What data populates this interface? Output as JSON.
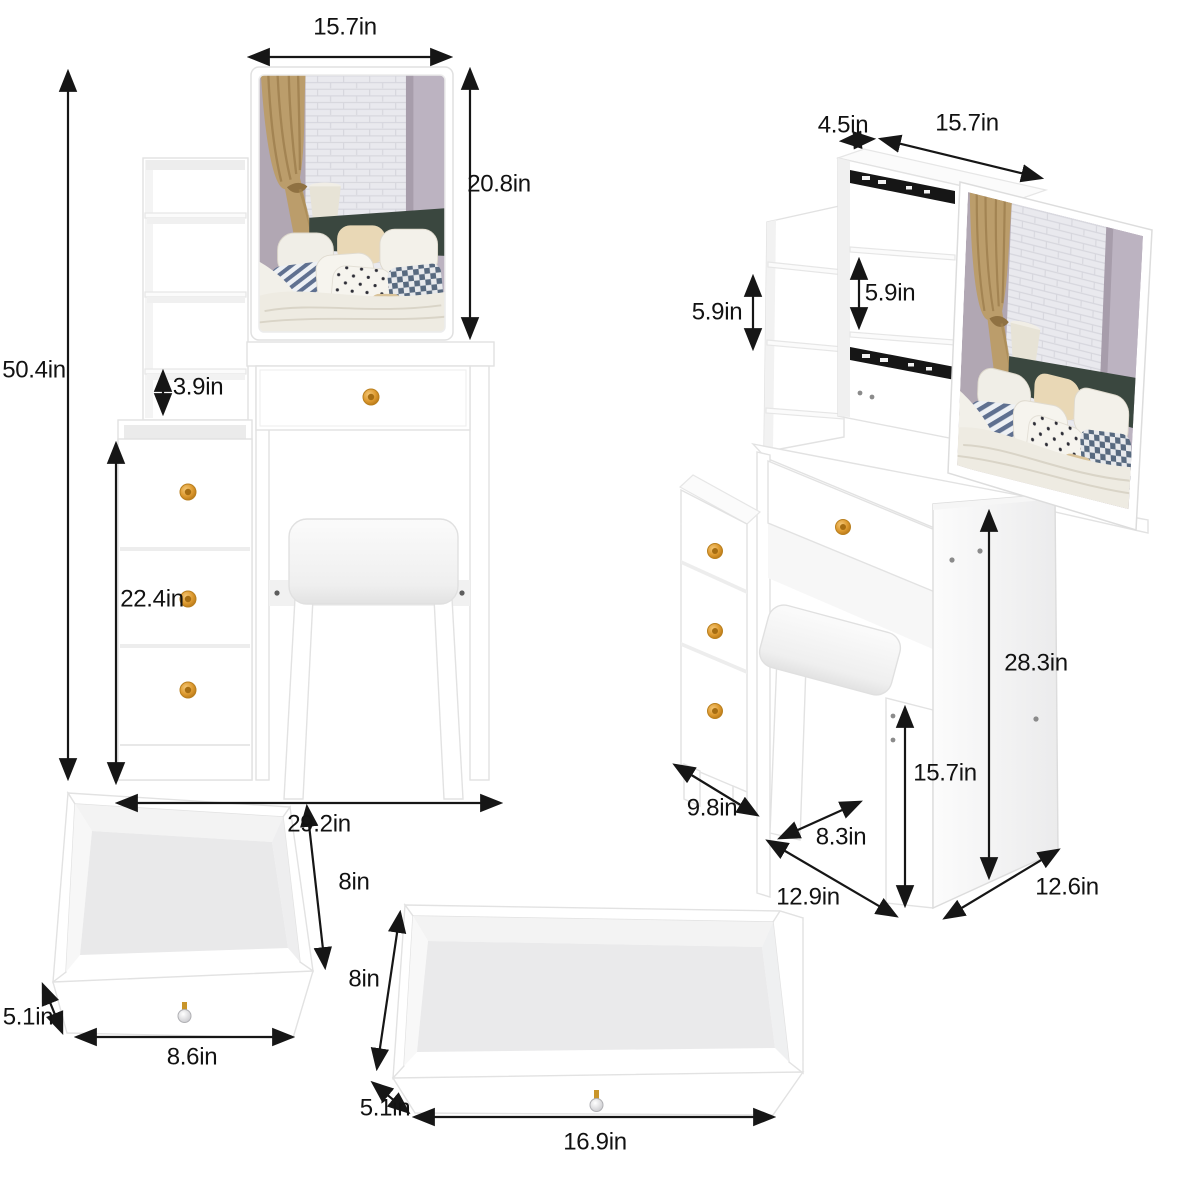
{
  "product": "vanity-table-set-dimension-diagram",
  "views": {
    "front": {
      "dims": {
        "mirror_width": "15.7in",
        "mirror_height": "20.8in",
        "total_height": "50.4in",
        "shelf_gap": "3.9in",
        "cabinet_height": "22.4in",
        "total_width": "29.2in"
      }
    },
    "side": {
      "dims": {
        "top_depth": "4.5in",
        "mirror_width": "15.7in",
        "side_shelf_spacing": "5.9in",
        "hutch_shelf_spacing": "5.9in",
        "table_height": "28.3in",
        "stool_height": "15.7in",
        "cabinet_depth": "9.8in",
        "stool_depth": "8.3in",
        "tabletop_depth": "12.9in",
        "side_panel_depth": "12.6in"
      }
    },
    "small_drawer": {
      "dims": {
        "depth": "8in",
        "height": "5.1in",
        "width": "8.6in"
      }
    },
    "large_drawer": {
      "dims": {
        "depth": "8in",
        "height": "5.1in",
        "width": "16.9in"
      }
    }
  },
  "icons": {
    "dimension_arrow": "double-headed-arrow",
    "drawer_knob": "gold-crystal-knob",
    "slide_rail": "black-drawer-slide-rail"
  },
  "colors": {
    "background": "#ffffff",
    "dimension_text": "#121212",
    "arrow": "#161616",
    "furniture_white": "#ffffff",
    "knob_gold": "#cf8a2a",
    "slide_rail_black": "#161616",
    "mirror_wall_lavender": "#b1a7b3",
    "headboard_green": "#3a473f",
    "bedding_cream": "#eeebe2"
  }
}
